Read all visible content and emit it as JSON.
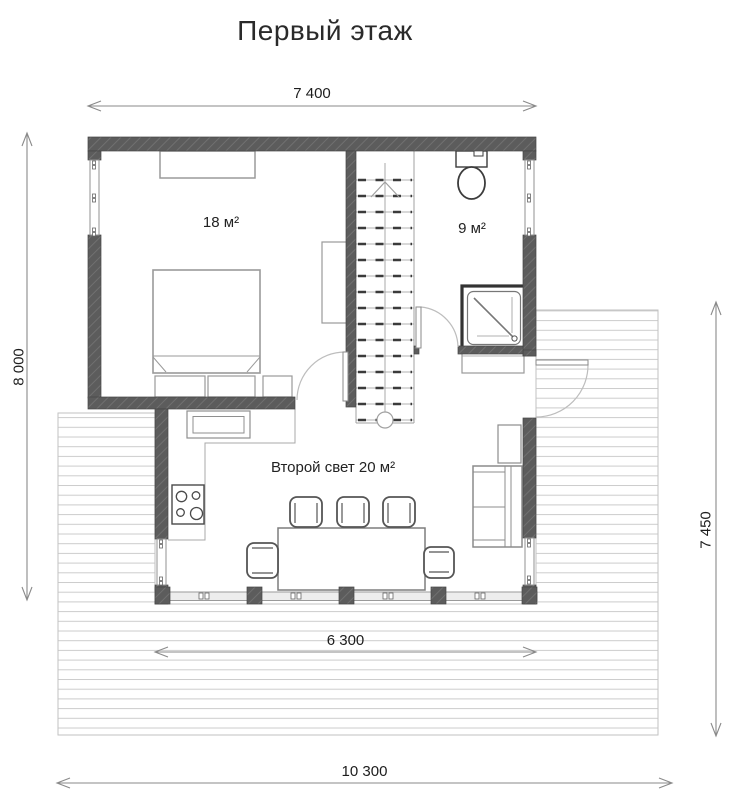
{
  "page": {
    "title": "Первый этаж"
  },
  "dimensions": {
    "top_width": "7 400",
    "left_height": "8 000",
    "right_height": "7 450",
    "terrace_width": "6 300",
    "total_width": "10 300"
  },
  "rooms": {
    "bedroom_area": "18 м²",
    "bathroom_area": "9 м²",
    "living_area": "Второй свет 20 м²"
  },
  "colors": {
    "wall": "#5c5c5c",
    "wall_hatch": "#707070",
    "furniture_outline": "#8c8c8c",
    "fixture_outline": "#3c3c3c",
    "deck_plank": "#cccccc",
    "dimension_line": "#8a8a8a",
    "door_arc": "#bdbdbd",
    "text": "#1d1d1d",
    "background": "#ffffff"
  }
}
